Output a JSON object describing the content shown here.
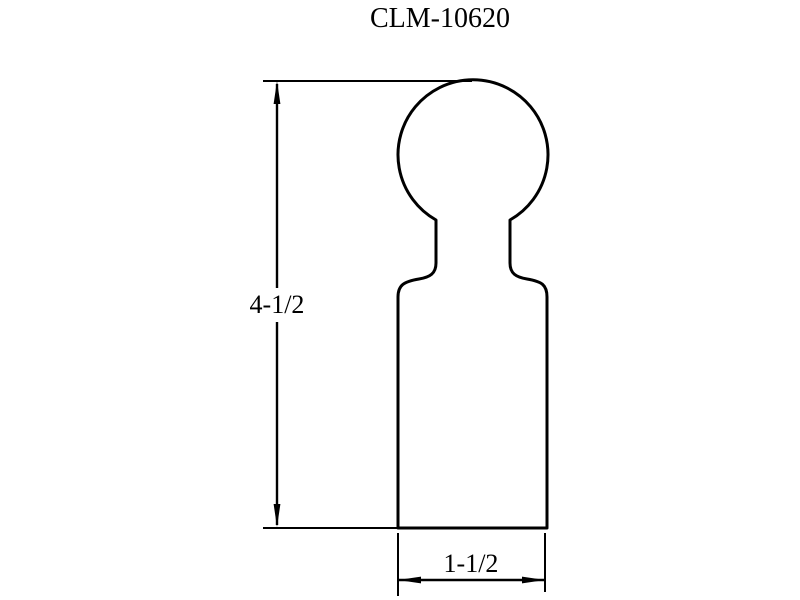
{
  "title": "CLM-10620",
  "dimensions": {
    "height": {
      "label": "4-1/2"
    },
    "width": {
      "label": "1-1/2"
    }
  },
  "colors": {
    "line": "#000000",
    "text": "#000000",
    "background": "#ffffff"
  }
}
